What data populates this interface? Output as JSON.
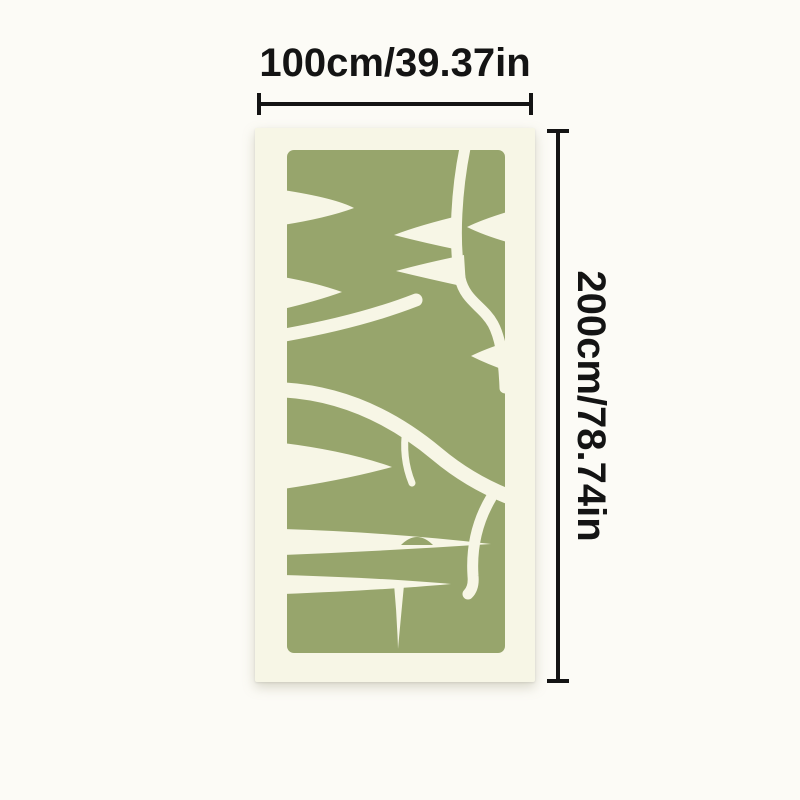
{
  "diagram": {
    "width_label": "100cm/39.37in",
    "height_label": "200cm/78.74in"
  },
  "product": {
    "description": "vertical rug with abstract sage-green squiggle pattern on cream canvas"
  },
  "icons": {
    "width_measure": "horizontal-double-ended-measure-line",
    "height_measure": "vertical-double-ended-measure-line"
  },
  "colors": {
    "page_background": "#FCFBF6",
    "rug_canvas": "#F7F6E6",
    "pattern_green": "#97A56C",
    "dimension_line": "#141414"
  }
}
